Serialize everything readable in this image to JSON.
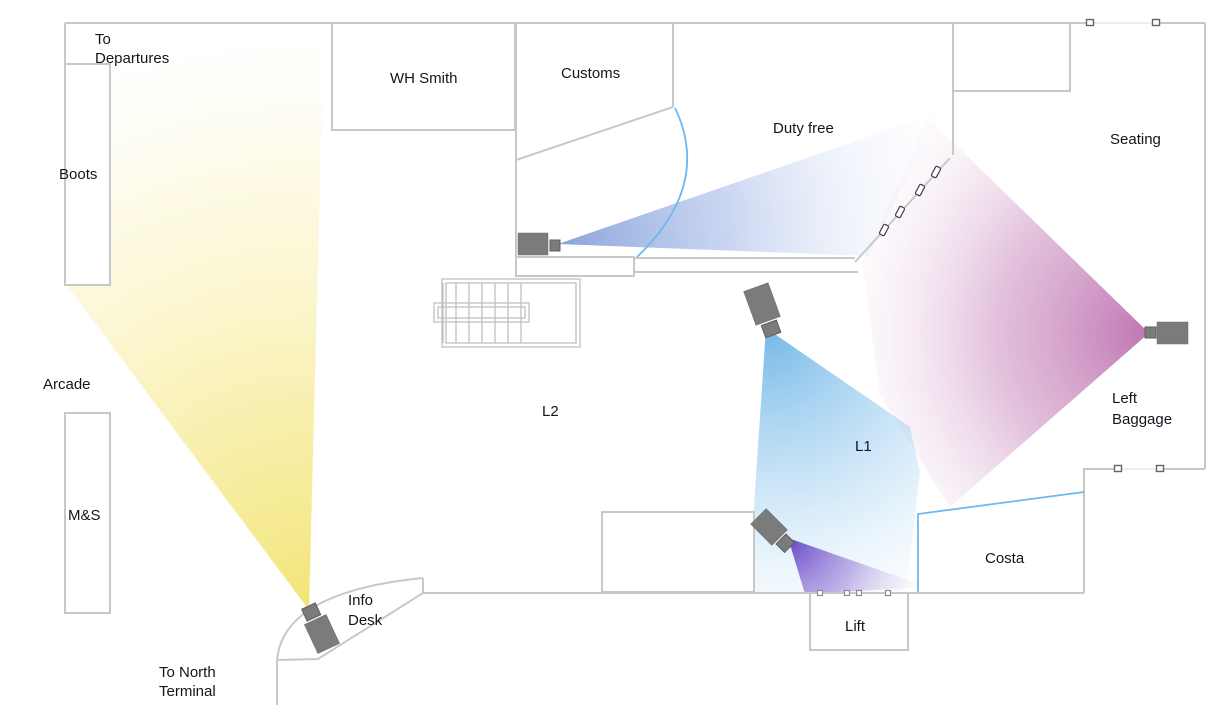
{
  "diagram": {
    "type": "airport-terminal-cctv-floor-plan",
    "labels": {
      "to_departures": {
        "lines": [
          "To",
          "Departures"
        ]
      },
      "boots": {
        "lines": [
          "Boots"
        ]
      },
      "arcade": {
        "lines": [
          "Arcade"
        ]
      },
      "ms": {
        "lines": [
          "M&S"
        ]
      },
      "wh_smith": {
        "lines": [
          "WH Smith"
        ]
      },
      "customs": {
        "lines": [
          "Customs"
        ]
      },
      "duty_free": {
        "lines": [
          "Duty free"
        ]
      },
      "seating": {
        "lines": [
          "Seating"
        ]
      },
      "l2": {
        "lines": [
          "L2"
        ]
      },
      "l1": {
        "lines": [
          "L1"
        ]
      },
      "left_baggage": {
        "lines": [
          "Left",
          "Baggage"
        ]
      },
      "costa": {
        "lines": [
          "Costa"
        ]
      },
      "lift": {
        "lines": [
          "Lift"
        ]
      },
      "info_desk": {
        "lines": [
          "Info",
          "Desk"
        ]
      },
      "to_north_terminal": {
        "lines": [
          "To North",
          "Terminal"
        ]
      }
    },
    "cameras": [
      {
        "id": "customs-camera",
        "cone_color": "#7c99d6",
        "direction": "right"
      },
      {
        "id": "left-baggage-camera",
        "cone_color": "#b966aa",
        "direction": "left"
      },
      {
        "id": "l1-camera",
        "cone_color": "#64afe5",
        "direction": "down"
      },
      {
        "id": "lift-camera",
        "cone_color": "#5f3dc4",
        "direction": "down-right"
      },
      {
        "id": "info-desk-camera",
        "cone_color": "#f1e36e",
        "direction": "up-left"
      }
    ],
    "colors": {
      "wall": "#c8c8c8",
      "door_swing": "#6fb8ef",
      "costa_boundary": "#6fb8ef",
      "camera_body": "#7b7b7b",
      "text": "#14141e"
    }
  }
}
